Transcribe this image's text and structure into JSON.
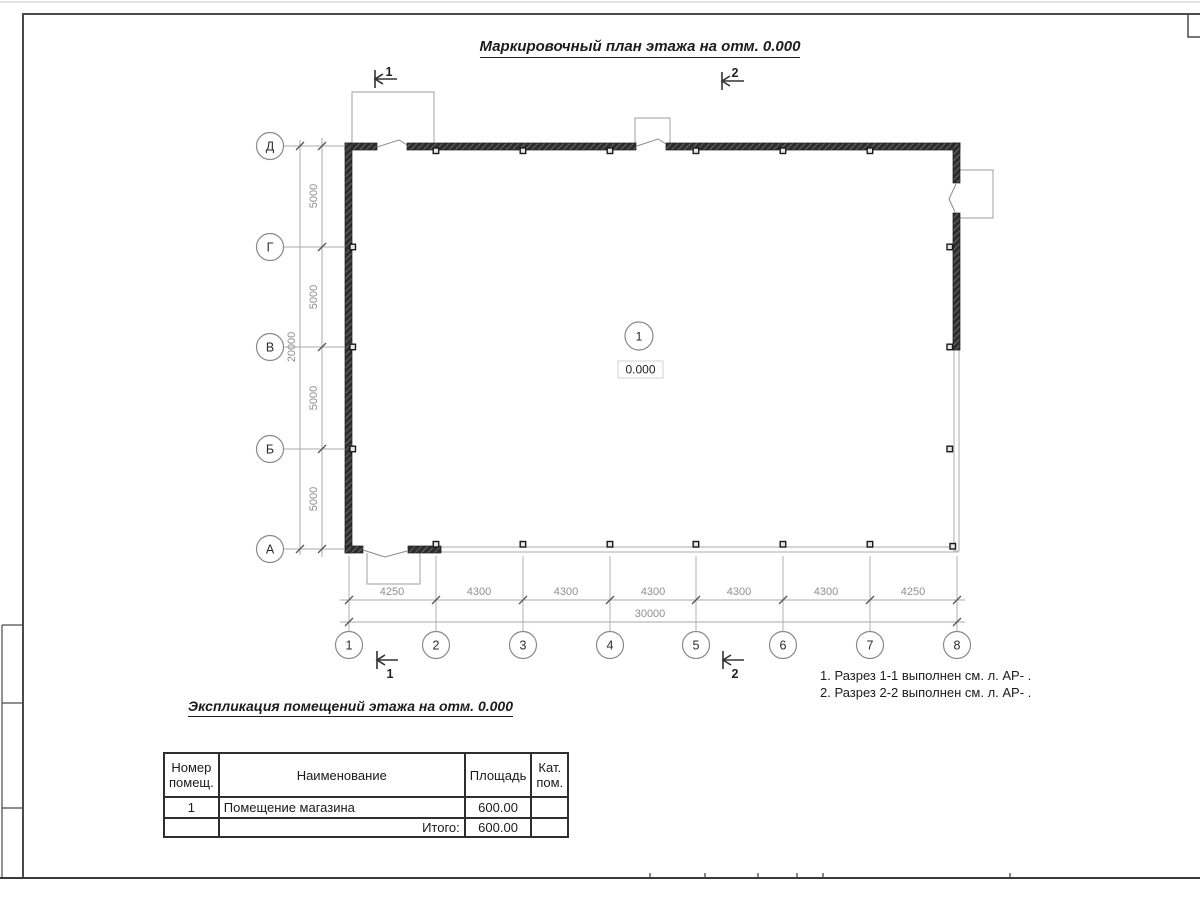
{
  "page": {
    "title": "Маркировочный план этажа на отм. 0.000",
    "notes": "1. Разрез 1-1 выполнен см. л. АР- .\n2. Разрез 2-2 выполнен см. л. АР- ."
  },
  "plan": {
    "room": {
      "number": "1",
      "elevation": "0.000"
    },
    "grid": {
      "rows": [
        "Д",
        "Г",
        "В",
        "Б",
        "А"
      ],
      "cols": [
        "1",
        "2",
        "3",
        "4",
        "5",
        "6",
        "7",
        "8"
      ]
    },
    "dims": {
      "bottom": [
        "4250",
        "4300",
        "4300",
        "4300",
        "4300",
        "4300",
        "4250"
      ],
      "bottom_total": "30000",
      "left": [
        "5000",
        "5000",
        "5000",
        "5000"
      ],
      "left_total": "20000"
    },
    "sections": {
      "one": "1",
      "two": "2"
    }
  },
  "expl": {
    "title": "Экспликация помещений этажа на отм. 0.000",
    "headers": [
      "Номер\nпомещ.",
      "Наименование",
      "Площадь",
      "Кат.\nпом."
    ],
    "rows": [
      {
        "num": "1",
        "name": "Помещение магазина",
        "area": "600.00",
        "cat": ""
      }
    ],
    "total_label": "Итого:",
    "total_value": "600.00"
  },
  "colors": {
    "ink": "#2e2e2e",
    "wall_dark": "#2e2e2e",
    "wall_light": "#b9b9b9",
    "dim_text": "#8f8f8f",
    "grid_line": "#a8a8a8"
  }
}
